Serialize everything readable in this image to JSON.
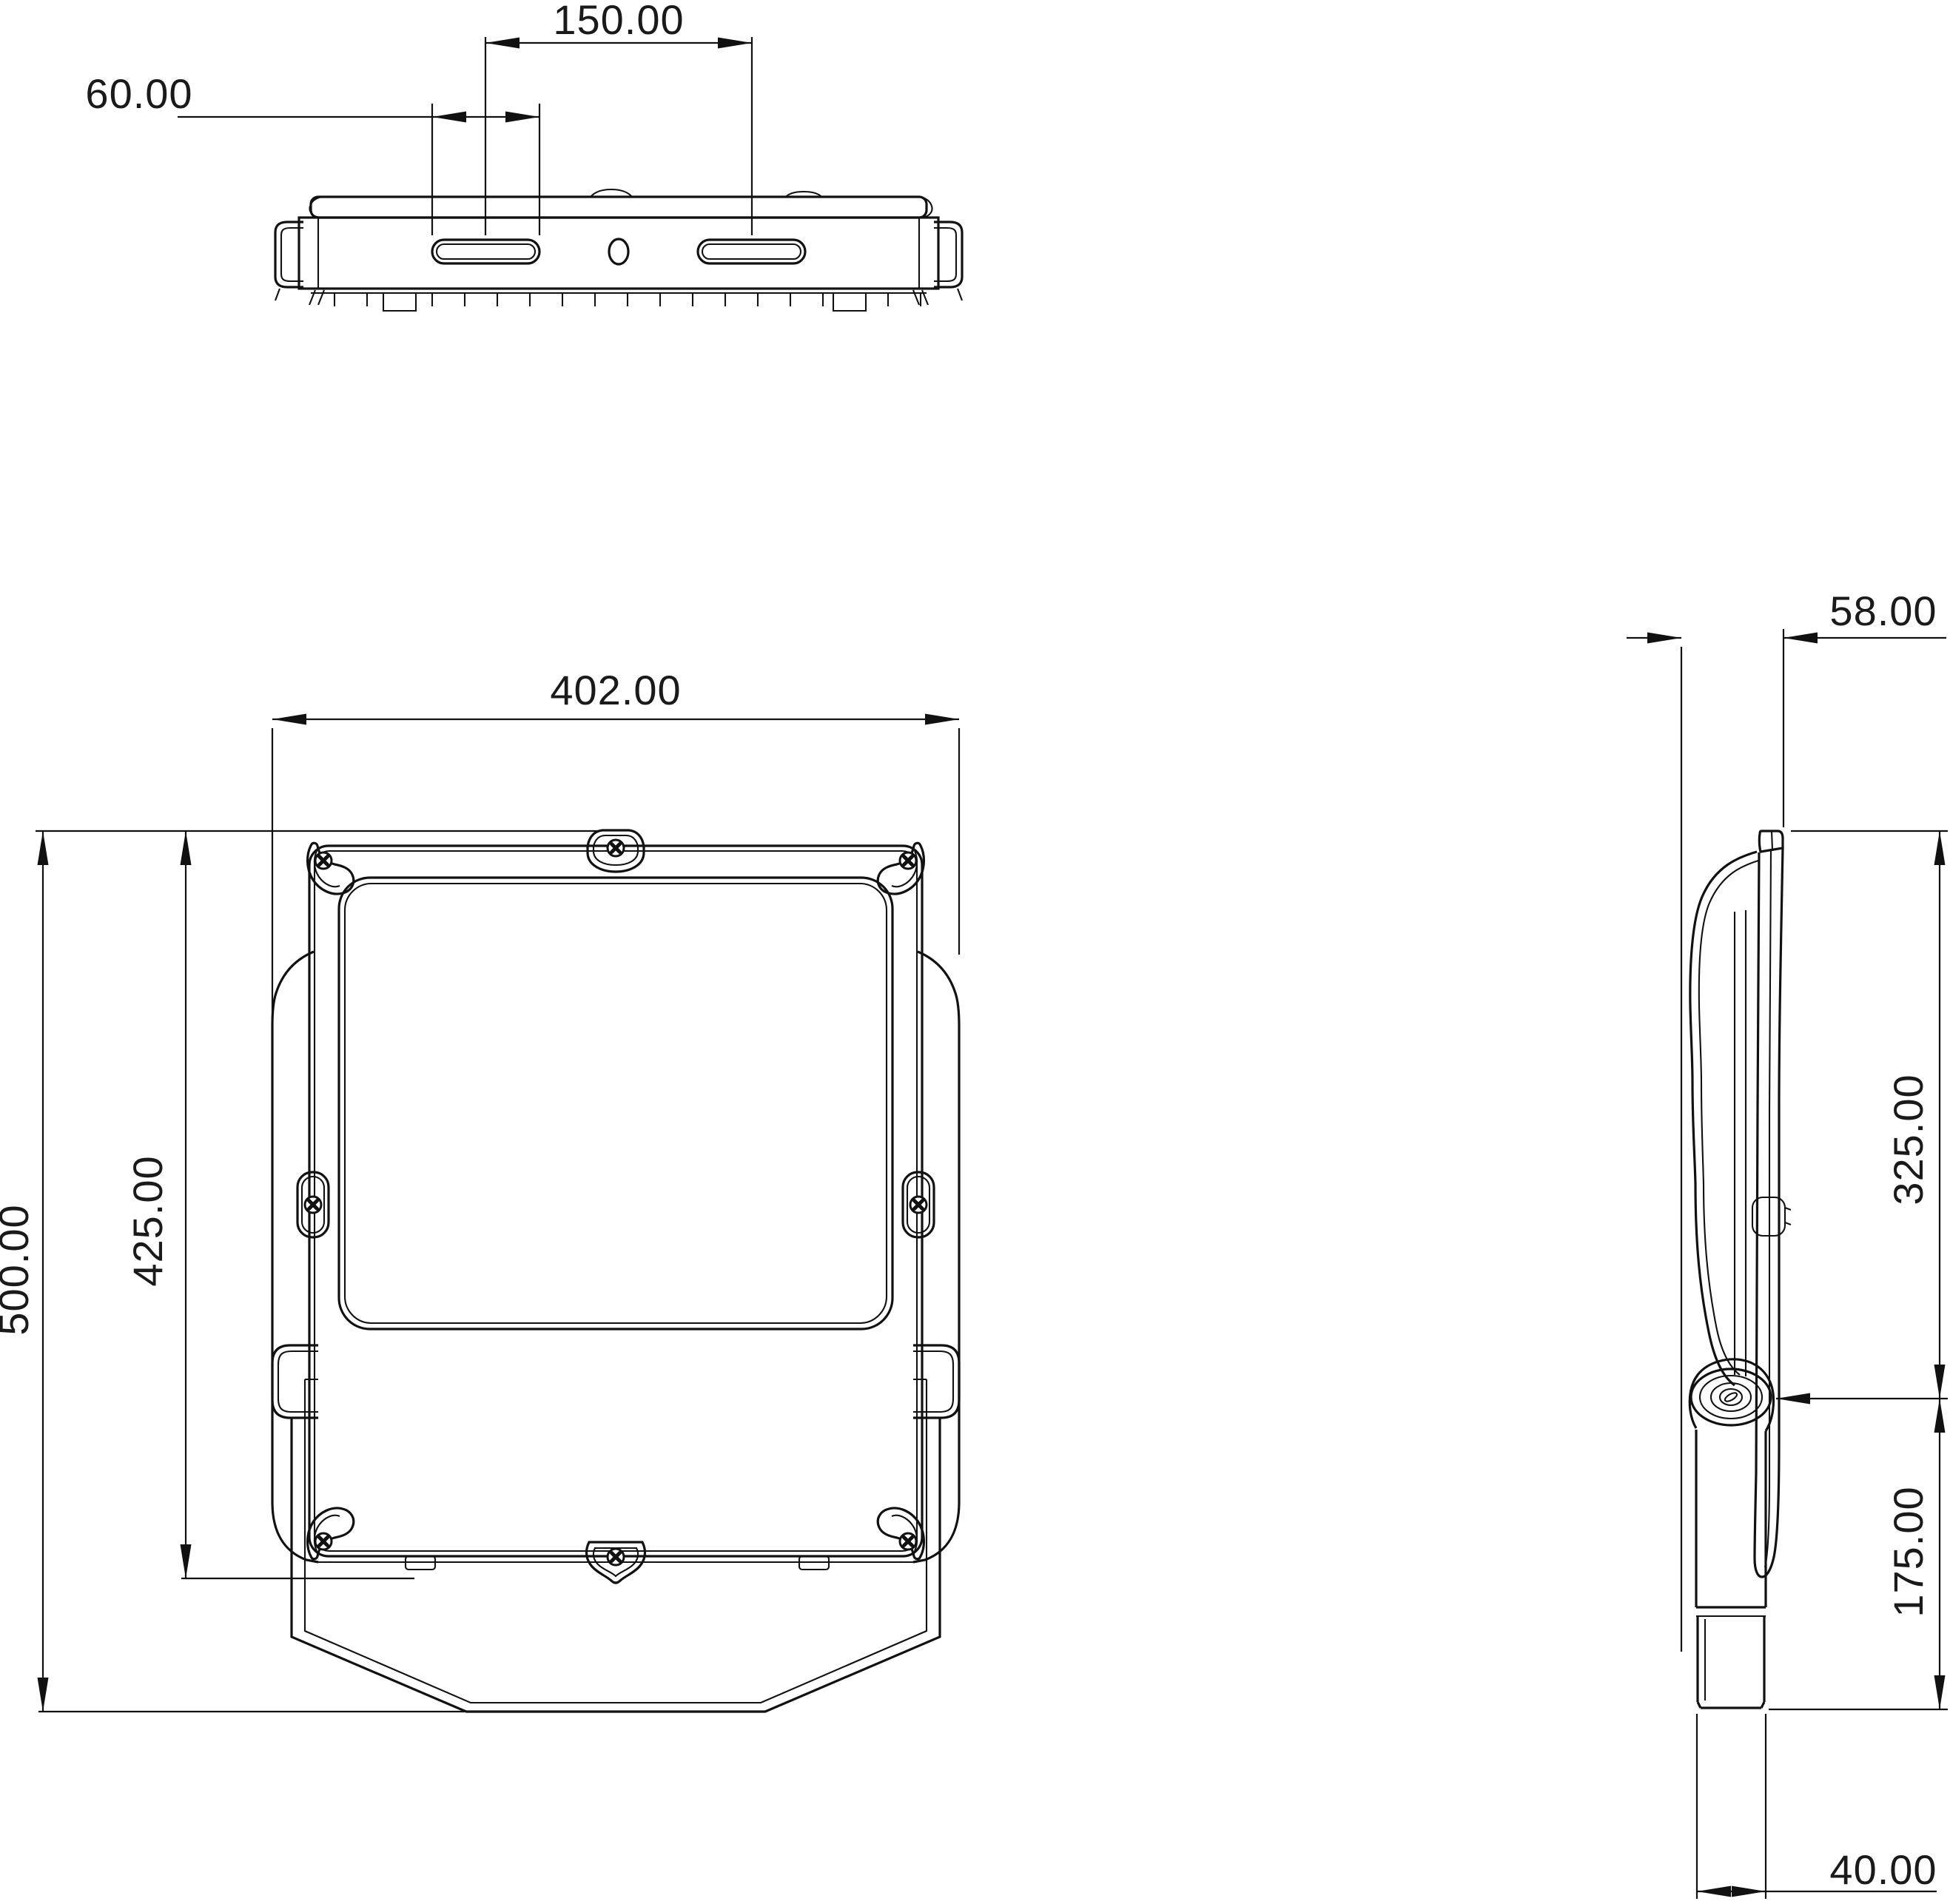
{
  "sheet": {
    "background": "#ffffff",
    "line_color": "#111111",
    "drawing_type": "floodlight dimension drawing"
  },
  "views": {
    "top": {
      "name": "top-view",
      "dims": {
        "slot_spacing": "150.00",
        "slot_length": "60.00"
      }
    },
    "front": {
      "name": "front-view",
      "dims": {
        "overall_width": "402.00",
        "body_height": "425.00",
        "overall_height": "500.00"
      }
    },
    "side": {
      "name": "side-view",
      "dims": {
        "depth": "58.00",
        "top_to_pivot": "325.00",
        "pivot_to_bottom": "175.00",
        "bracket_width": "40.00"
      }
    }
  }
}
